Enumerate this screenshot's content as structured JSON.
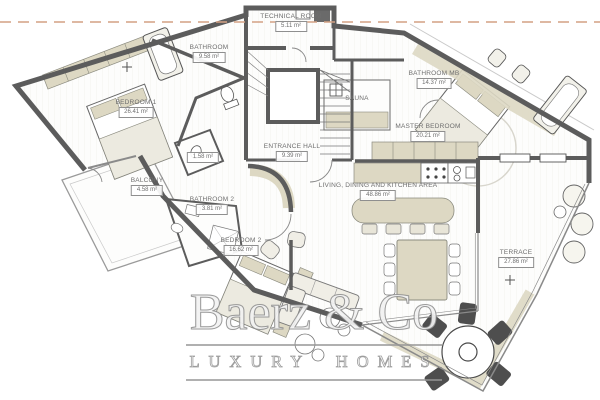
{
  "plan": {
    "rooms": [
      {
        "name": "TECHNICAL ROOM",
        "area": "5.11 m²"
      },
      {
        "name": "BATHROOM",
        "area": "9.58 m²"
      },
      {
        "name": "BEDROOM 1",
        "area": "26.41 m²"
      },
      {
        "name": "BATHROOM MB",
        "area": "14.37 m²"
      },
      {
        "name": "SAUNA",
        "area": ""
      },
      {
        "name": "MASTER BEDROOM",
        "area": "20.21 m²"
      },
      {
        "name": "ENTRANCE HALL",
        "area": "9.39 m²"
      },
      {
        "name": "",
        "area": "1.58 m²"
      },
      {
        "name": "BALCONY",
        "area": "4.58 m²"
      },
      {
        "name": "BATHROOM 2",
        "area": "3.81 m²"
      },
      {
        "name": "BEDROOM 2",
        "area": "16.62 m²"
      },
      {
        "name": "LIVING, DINING AND KITCHEN AREA",
        "area": "48.86 m²"
      },
      {
        "name": "TERRACE",
        "area": "27.86 m²"
      }
    ],
    "watermark": {
      "brand": "Baerz & Co",
      "tagline": "LUXURY HOMES"
    },
    "colors": {
      "wall": "#5c5c5c",
      "furniture": "#ddd8c3",
      "floor": "#fdfdfc",
      "dashed_line": "#d3a183",
      "label_text": "#6e6e6e",
      "watermark_outline": "#8e8e8e"
    }
  }
}
